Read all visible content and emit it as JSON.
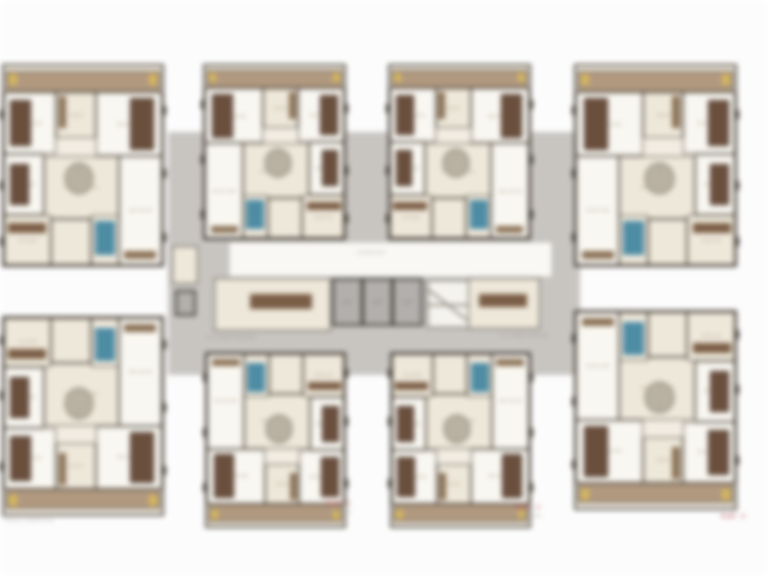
{
  "meta": {
    "title": "Typical floor plan - 8 unit residential cluster",
    "canvas": {
      "w": 768,
      "h": 576
    }
  },
  "palette": {
    "bg": "#ffffff",
    "corridor_gray": "#c9c6c2",
    "wall_dark": "#4a423a",
    "room_cream": "#f0eadc",
    "room_white": "#fbf9f3",
    "balcony_tan": "#b29a80",
    "wood_brown": "#6b4e3c",
    "counter_brown": "#7a5c44",
    "fixture_blue": "#4d8ca5",
    "door_yellow": "#d8b85c",
    "motif_gray": "#a79e8f",
    "label_red": "#b4454d"
  },
  "corridor": {
    "band": {
      "x": 168,
      "y": 132,
      "w": 412,
      "h": 243
    },
    "left_arm_room": {
      "x": 172,
      "y": 246,
      "w": 26,
      "h": 38
    },
    "left_arm_shaft": {
      "x": 175,
      "y": 290,
      "w": 21,
      "h": 26
    },
    "hall": {
      "x": 228,
      "y": 241,
      "w": 325,
      "h": 37
    },
    "hall_label": {
      "text": "CORRIDOR",
      "x": 371,
      "y": 250
    },
    "service_rooms": [
      {
        "x": 214,
        "y": 278,
        "w": 117,
        "h": 53
      },
      {
        "x": 468,
        "y": 278,
        "w": 72,
        "h": 51
      }
    ],
    "service_counters": [
      {
        "x": 250,
        "y": 294,
        "w": 62,
        "h": 15
      },
      {
        "x": 479,
        "y": 294,
        "w": 48,
        "h": 13
      }
    ],
    "lifts": [
      {
        "x": 332,
        "y": 278,
        "w": 31,
        "h": 48,
        "label": "LIFT"
      },
      {
        "x": 362,
        "y": 278,
        "w": 31,
        "h": 48,
        "label": "LIFT"
      },
      {
        "x": 392,
        "y": 278,
        "w": 31,
        "h": 48,
        "label": "LIFT"
      }
    ],
    "stair": {
      "x": 427,
      "y": 280,
      "w": 42,
      "h": 48,
      "label": "STAIR"
    },
    "captions": [
      {
        "text": "6'-6\" WIDE PASSAGE",
        "x": 207,
        "y": 335
      },
      {
        "text": "6'-6\" WIDE PASSAGE",
        "x": 500,
        "y": 333
      }
    ]
  },
  "units": [
    {
      "id": "unit-1",
      "x": 2,
      "y": 64,
      "w": 162,
      "h": 203,
      "flip": "none"
    },
    {
      "id": "unit-2",
      "x": 203,
      "y": 64,
      "w": 143,
      "h": 176,
      "flip": "x"
    },
    {
      "id": "unit-3",
      "x": 388,
      "y": 64,
      "w": 143,
      "h": 176,
      "flip": "none"
    },
    {
      "id": "unit-4",
      "x": 574,
      "y": 64,
      "w": 163,
      "h": 203,
      "flip": "x"
    },
    {
      "id": "unit-5",
      "x": 2,
      "y": 316,
      "w": 162,
      "h": 200,
      "flip": "y"
    },
    {
      "id": "unit-6",
      "x": 205,
      "y": 352,
      "w": 141,
      "h": 176,
      "flip": "xy"
    },
    {
      "id": "unit-7",
      "x": 390,
      "y": 352,
      "w": 141,
      "h": 176,
      "flip": "y"
    },
    {
      "id": "unit-8",
      "x": 574,
      "y": 310,
      "w": 163,
      "h": 200,
      "flip": "xy"
    }
  ],
  "unit_template": {
    "rooms": [
      {
        "name": "balcony",
        "x": 1.5,
        "y": 2.5,
        "w": 97,
        "h": 10.5,
        "kind": "balcony",
        "label": ""
      },
      {
        "name": "bedroom-1",
        "x": 0,
        "y": 13,
        "w": 33,
        "h": 31,
        "kind": "white",
        "label": "BED ROOM"
      },
      {
        "name": "toilet-1",
        "x": 33,
        "y": 13,
        "w": 25,
        "h": 23,
        "kind": "cream",
        "label": "TOILET"
      },
      {
        "name": "bedroom-2",
        "x": 58,
        "y": 13,
        "w": 42,
        "h": 32,
        "kind": "white",
        "label": "BED ROOM"
      },
      {
        "name": "bedroom-3",
        "x": 0,
        "y": 44,
        "w": 25,
        "h": 31,
        "kind": "white",
        "label": "BED ROOM"
      },
      {
        "name": "living-dining",
        "x": 25,
        "y": 45,
        "w": 48,
        "h": 32,
        "kind": "cream",
        "label": "LIVING / DINING"
      },
      {
        "name": "bedroom-4",
        "x": 73,
        "y": 45,
        "w": 27,
        "h": 55,
        "kind": "white",
        "label": "BED ROOM"
      },
      {
        "name": "kitchen",
        "x": 0,
        "y": 75,
        "w": 30,
        "h": 25,
        "kind": "cream",
        "label": "KITCHEN"
      },
      {
        "name": "foyer",
        "x": 30,
        "y": 77,
        "w": 25,
        "h": 23,
        "kind": "cream",
        "label": ""
      },
      {
        "name": "toilet-2",
        "x": 55,
        "y": 75,
        "w": 18,
        "h": 25,
        "kind": "cream",
        "label": "TOILET"
      }
    ],
    "furniture": [
      {
        "type": "door",
        "x": 3,
        "y": 4,
        "w": 5,
        "h": 5.5
      },
      {
        "type": "door",
        "x": 92,
        "y": 4,
        "w": 5,
        "h": 5.5
      },
      {
        "type": "bed",
        "x": 4,
        "y": 17,
        "w": 13,
        "h": 23
      },
      {
        "type": "bed",
        "x": 80,
        "y": 16,
        "w": 15,
        "h": 26
      },
      {
        "type": "bed",
        "x": 4,
        "y": 49,
        "w": 12,
        "h": 21
      },
      {
        "type": "wardrobe",
        "x": 34.5,
        "y": 15,
        "w": 5,
        "h": 16
      },
      {
        "type": "motif",
        "x": 39,
        "y": 49,
        "w": 17,
        "h": 15
      },
      {
        "type": "counter",
        "x": 2.5,
        "y": 79,
        "w": 24,
        "h": 5
      },
      {
        "type": "shower",
        "x": 57.5,
        "y": 78,
        "w": 13,
        "h": 17
      },
      {
        "type": "wardrobe",
        "x": 76,
        "y": 93,
        "w": 20,
        "h": 4
      }
    ],
    "window_ticks": [
      {
        "side": "left",
        "t": 22
      },
      {
        "side": "left",
        "t": 58
      },
      {
        "side": "left",
        "t": 86
      },
      {
        "side": "right",
        "t": 20
      },
      {
        "side": "right",
        "t": 52
      },
      {
        "side": "right",
        "t": 84
      }
    ]
  },
  "annotations": {
    "flat_labels": [
      {
        "text": "FLAT - 2",
        "sub": "EAST FACING",
        "x": 338,
        "y": 501
      },
      {
        "text": "FLAT - 3",
        "sub": "WEST FACING",
        "x": 528,
        "y": 505
      },
      {
        "text": "FLAT - 4",
        "sub": "",
        "x": 733,
        "y": 514
      }
    ],
    "corner_note": {
      "text": "TYPICAL FLOOR PLAN",
      "x": 3,
      "y": 518
    }
  }
}
